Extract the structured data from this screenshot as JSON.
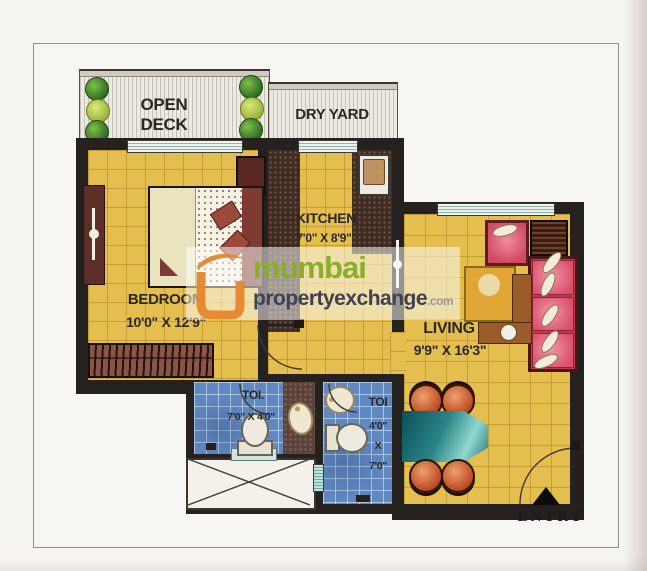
{
  "watermark": {
    "brand_top": "mumbai",
    "brand_bottom": "propertyexchange",
    "brand_suffix": ".com"
  },
  "labels": {
    "open_deck_1": "OPEN",
    "open_deck_2": "DECK",
    "dry_yard": "DRY YARD",
    "kitchen": "KITCHEN",
    "kitchen_dims": "7'0\" X 8'9\"",
    "bedroom": "BEDROOM",
    "bedroom_dims": "10'0\" X 12'9\"",
    "living": "LIVING",
    "living_dims": "9'9\" X 16'3\"",
    "toilet_left": "TOI.",
    "toilet_left_dims": "7'0\" X 4'0\"",
    "toilet_right": "TOI",
    "toilet_right_dim_w": "4'0\"",
    "toilet_right_x": "X",
    "toilet_right_dim_h": "7'0\"",
    "entry": "ENTRY"
  },
  "colors": {
    "floor_yellow": "#e4be4e",
    "tile_line": "#b78e2a",
    "wall_black": "#24211f",
    "toilet_blue": "#6189c1",
    "deck_stripe": "#edeae3",
    "platform_brown": "#3f2b21",
    "sofa_pink": "#e8738c",
    "sofa_crimson": "#bf3a50",
    "dining_teal": "#2a7f82",
    "chair_orange": "#c3562d",
    "coffee_amber": "#e2a637",
    "wood_brown": "#9a5c28",
    "bed_maroon": "#7d3b33",
    "wardrobe_brown": "#8a5546",
    "brand_green": "#8aad2d",
    "brand_dark": "#3e4152",
    "brand_orange": "#e5862c"
  }
}
